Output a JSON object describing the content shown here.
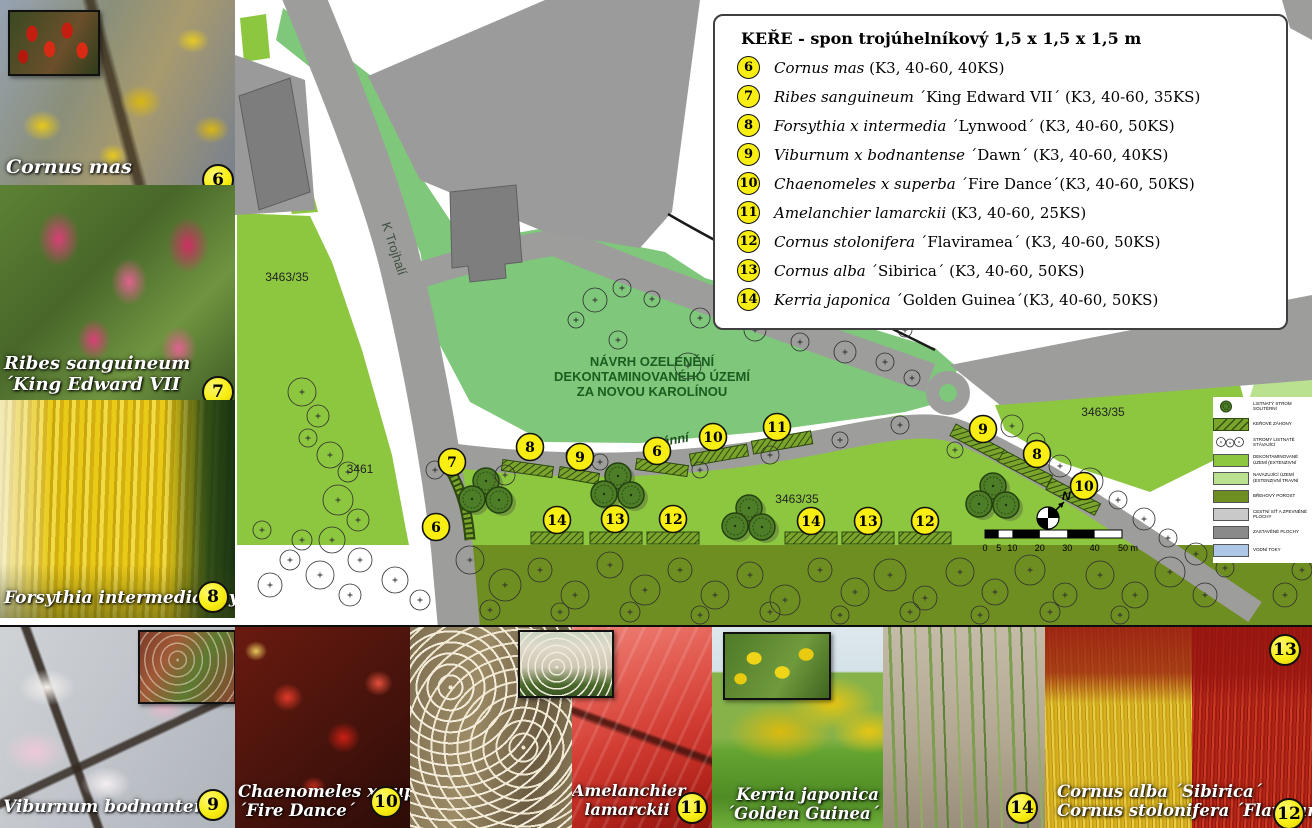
{
  "legend": {
    "title": "KEŘE - spon trojúhelníkový 1,5 x 1,5 x 1,5 m",
    "items": [
      {
        "num": "6",
        "name": "Cornus mas",
        "rest": " (K3, 40-60, 40KS)"
      },
      {
        "num": "7",
        "name": "Ribes sanguineum",
        "rest": " ´King Edward VII´ (K3, 40-60, 35KS)"
      },
      {
        "num": "8",
        "name": "Forsythia x intermedia",
        "rest": " ´Lynwood´ (K3, 40-60, 50KS)"
      },
      {
        "num": "9",
        "name": "Viburnum x bodnantense",
        "rest": " ´Dawn´  (K3, 40-60, 40KS)"
      },
      {
        "num": "10",
        "name": "Chaenomeles x superba",
        "rest": " ´Fire Dance´(K3, 40-60, 50KS)"
      },
      {
        "num": "11",
        "name": "Amelanchier lamarckii",
        "rest": " (K3, 40-60, 25KS)"
      },
      {
        "num": "12",
        "name": "Cornus stolonifera",
        "rest": " ´Flaviramea´ (K3, 40-60, 50KS)"
      },
      {
        "num": "13",
        "name": "Cornus alba",
        "rest": " ´Sibirica´ (K3, 40-60, 50KS)"
      },
      {
        "num": "14",
        "name": "Kerria japonica",
        "rest": " ´Golden Guinea´(K3, 40-60, 50KS)"
      }
    ]
  },
  "map": {
    "title_lines": [
      "NÁVRH OZELENĚNÍ",
      "DEKONTAMINOVANÉHO ÚZEMÍ",
      "ZA NOVOU KAROLÍNOU"
    ],
    "street": "K Trojhalí",
    "street2": "ánní",
    "north_label": "N",
    "parcels": [
      {
        "label": "3463/35",
        "x": 287,
        "y": 281
      },
      {
        "label": "3461",
        "x": 360,
        "y": 473
      },
      {
        "label": "3463/35",
        "x": 797,
        "y": 503
      },
      {
        "label": "3463/35",
        "x": 1103,
        "y": 416
      }
    ],
    "markers": [
      {
        "n": "7",
        "x": 452,
        "y": 462
      },
      {
        "n": "8",
        "x": 530,
        "y": 447
      },
      {
        "n": "9",
        "x": 580,
        "y": 457
      },
      {
        "n": "6",
        "x": 436,
        "y": 527
      },
      {
        "n": "6",
        "x": 657,
        "y": 451
      },
      {
        "n": "10",
        "x": 713,
        "y": 437
      },
      {
        "n": "11",
        "x": 777,
        "y": 427
      },
      {
        "n": "14",
        "x": 557,
        "y": 520
      },
      {
        "n": "13",
        "x": 615,
        "y": 519
      },
      {
        "n": "12",
        "x": 673,
        "y": 519
      },
      {
        "n": "14",
        "x": 811,
        "y": 521
      },
      {
        "n": "13",
        "x": 868,
        "y": 521
      },
      {
        "n": "12",
        "x": 925,
        "y": 521
      },
      {
        "n": "9",
        "x": 983,
        "y": 429
      },
      {
        "n": "8",
        "x": 1037,
        "y": 454
      },
      {
        "n": "10",
        "x": 1084,
        "y": 486
      }
    ],
    "scale_labels": [
      "0",
      "5",
      "10",
      "20",
      "30",
      "40",
      "50 m"
    ]
  },
  "mini_legend": {
    "items": [
      {
        "label": "LISTNATÝ STROM SOLITÉRNÍ",
        "swatch": "tree"
      },
      {
        "label": "KEŘOVÉ ZÁHONY",
        "swatch": "hedge"
      },
      {
        "label": "STROMY LISTNATÉ STÁVAJÍCÍ",
        "swatch": "circles"
      },
      {
        "label": "DEKONTAMINOVANÉ ÚZEMÍ (EXTENZIVNÍ TRAVNÍ POROST)",
        "swatch": "#8dc63f"
      },
      {
        "label": "NAVAZUJÍCÍ ÚZEMÍ (EXTENZIVNÍ TRAVNÍ POROST)",
        "swatch": "#b9e190"
      },
      {
        "label": "BŘEHOVÝ POROST",
        "swatch": "#6f8e22"
      },
      {
        "label": "CESTNÍ SÍŤ A ZPEVNĚNÉ PLOCHY",
        "swatch": "#c9c9c9"
      },
      {
        "label": "ZASTAVĚNÉ PLOCHY",
        "swatch": "#8a8a8a"
      },
      {
        "label": "VODNÍ TOKY",
        "swatch": "#aec6e8"
      }
    ]
  },
  "photos": {
    "cornus_mas": {
      "caption": "Cornus mas",
      "badge": "6"
    },
    "ribes": {
      "caption1": "Ribes sanguineum",
      "caption2": "´King Edward VII",
      "badge": "7"
    },
    "forsythia": {
      "caption": "Forsythia intermedia ´Lynwood",
      "badge": "8"
    },
    "viburnum": {
      "caption": "Viburnum bodnantense ´Dawn",
      "badge": "9"
    },
    "chaenomeles": {
      "caption1": "Chaenomeles x superba",
      "caption2": "´Fire  Dance´",
      "badge": "10"
    },
    "amelanchier": {
      "caption1": "Amelanchier",
      "caption2": "lamarckii",
      "badge": "11"
    },
    "kerria": {
      "caption1": "Kerria japonica",
      "caption2": "´Golden Guinea´"
    },
    "stems": {
      "badge": "14"
    },
    "cornus_stems": {
      "caption1": "Cornus alba ´Sibirica´",
      "caption2": "Cornus stolonifera ´Flaviramea´",
      "badge": "12",
      "badge_top": "13"
    }
  },
  "colors": {
    "badge_yellow": "#f8ee12",
    "map_green": "#8dc63f",
    "map_green_soft": "#7ec77b",
    "olive": "#6f8e22",
    "road_gray": "#9d9d9c",
    "title_green": "#1b5e20"
  }
}
